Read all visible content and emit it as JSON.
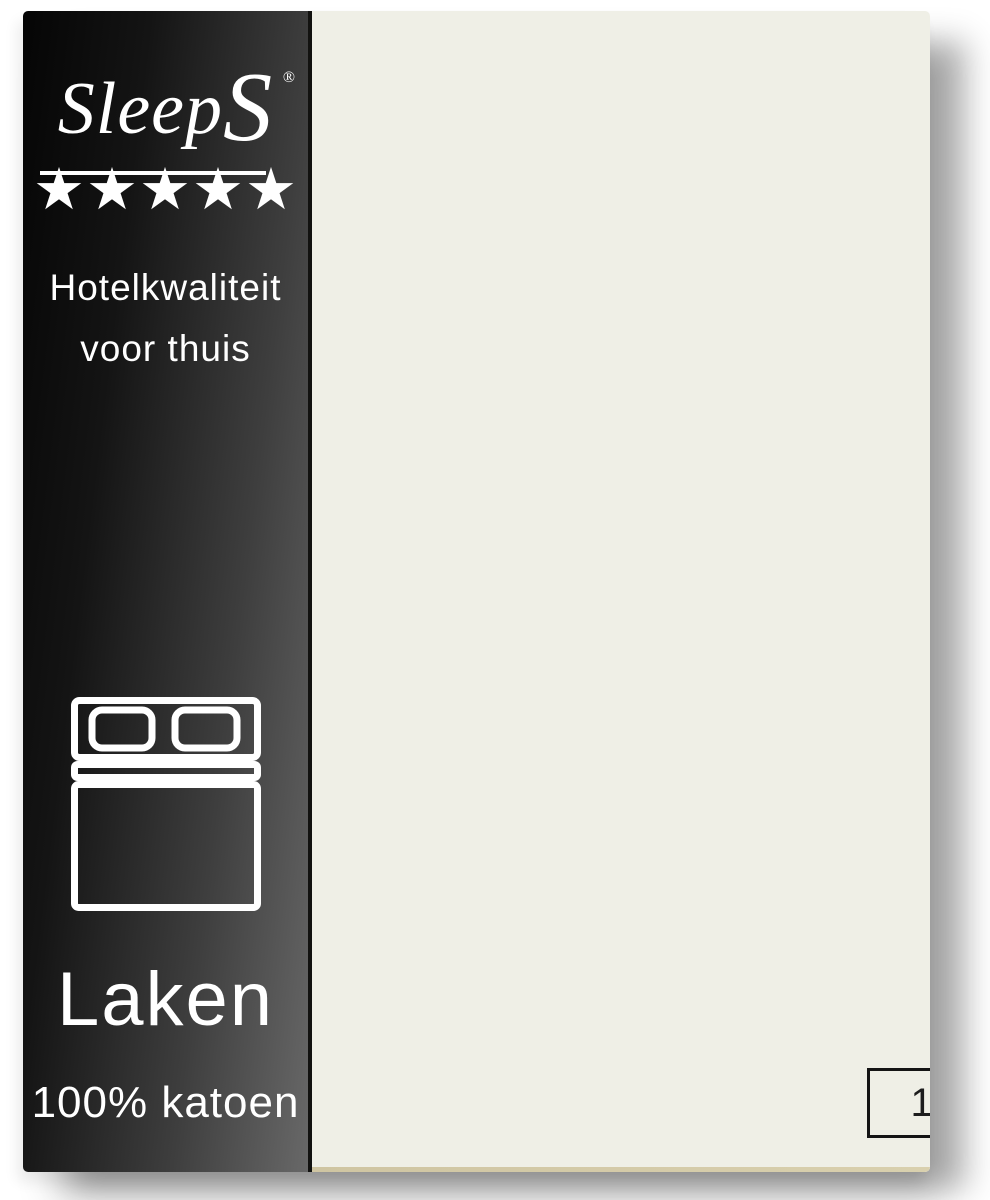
{
  "packaging": {
    "band": {
      "brand_logo": {
        "text_main": "Sleep",
        "text_cap_s": "S",
        "registered_mark": "®"
      },
      "rating": {
        "stars": "★★★★★"
      },
      "tagline": {
        "line1": "Hotelkwaliteit",
        "line2": "voor thuis"
      },
      "bed_icon": "double-bed-top-view",
      "product_type": "Laken",
      "material": "100% katoen",
      "colors": {
        "band_dark": "#050505",
        "band_light": "#686868",
        "text": "#ffffff"
      }
    },
    "sheet": {
      "color": "#efefe6",
      "size_box": {
        "label": "150x260 cm",
        "border_color": "#141414",
        "text_color": "#1d1d1d"
      }
    }
  }
}
